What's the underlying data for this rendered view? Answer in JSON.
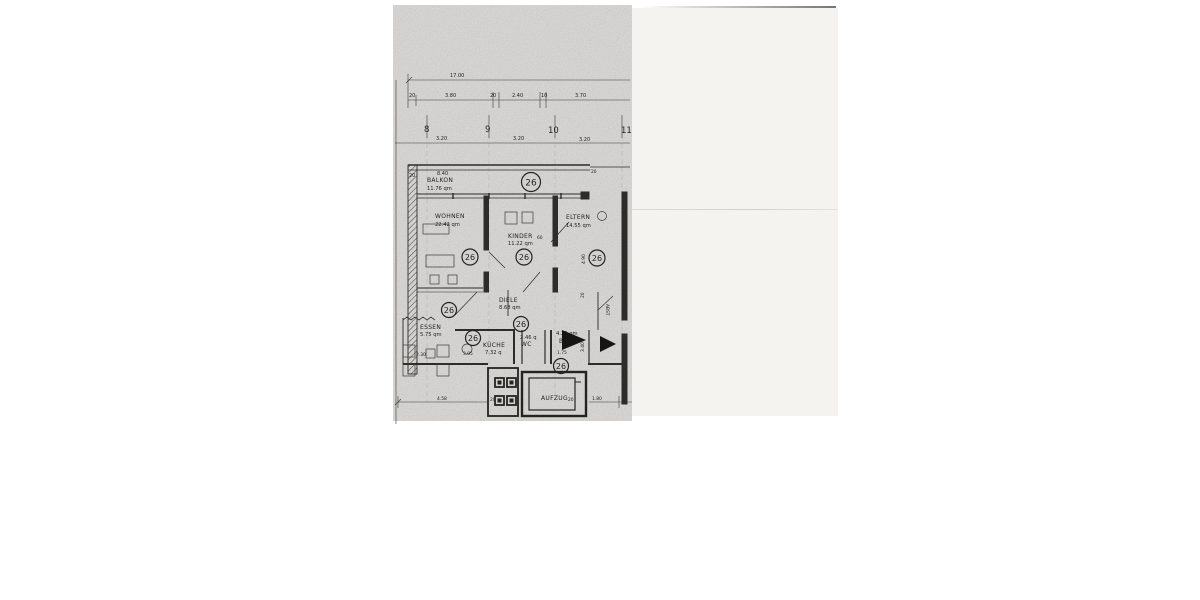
{
  "plan": {
    "unit_number": "26",
    "rooms": {
      "balkon": {
        "name": "BALKON",
        "area": "11.76 qm"
      },
      "wohnen": {
        "name": "WOHNEN",
        "area": "22.42 qm"
      },
      "kinder": {
        "name": "KINDER",
        "area": "11.22 qm"
      },
      "eltern": {
        "name": "ELTERN",
        "area": "14.55 qm"
      },
      "diele": {
        "name": "DIELE",
        "area": "8.68 qm"
      },
      "essen": {
        "name": "ESSEN",
        "area": "5.75 qm"
      },
      "kueche": {
        "name": "KÜCHE",
        "area": "7.32 q"
      },
      "wc": {
        "name": "WC",
        "area": "2.46 q"
      },
      "bad": {
        "name": "BAD",
        "area": "4.20 qm"
      },
      "aufzug": {
        "name": "AUFZUG"
      },
      "abst": {
        "name": "ABST"
      }
    },
    "dimensions": {
      "total_width": "17.00",
      "seg_380": "3.80",
      "seg_240": "2.40",
      "seg_370": "3.70",
      "d20": "20",
      "d10": "10",
      "d30": "30",
      "d60": "60",
      "bay": "3.20",
      "balcony_width": "8.40",
      "grid_8": "8",
      "grid_9": "9",
      "grid_10": "10",
      "grid_11": "11",
      "essen_w": "2.30",
      "essen_d": "3.05",
      "bad_w": "1.75",
      "eltern_d": "4.90",
      "abst_d": "3.40",
      "bottom_left": "4.58",
      "lift_w": "1.80"
    }
  }
}
